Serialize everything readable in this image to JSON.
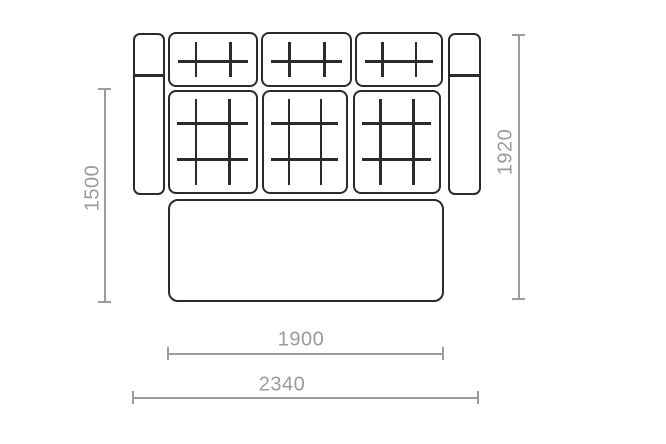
{
  "diagram": {
    "type": "furniture-dimension-drawing",
    "subject": "sofa-top-view",
    "dimensions": {
      "left_vertical": "1500",
      "right_vertical": "1920",
      "inner_horizontal": "1900",
      "outer_horizontal": "2340"
    },
    "colors": {
      "frame": "#2b2b2b",
      "dimension": "#9b9b9b",
      "background": "#ffffff"
    }
  }
}
